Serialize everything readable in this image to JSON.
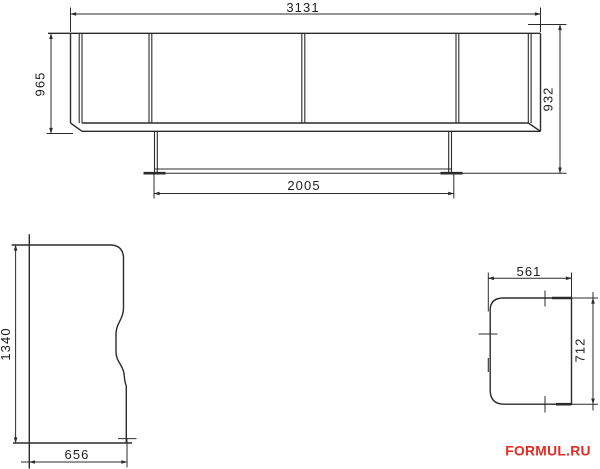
{
  "colors": {
    "background": "#ffffff",
    "line": "#2b2b2b",
    "dimension_text": "#1d1d1d",
    "watermark": "#e32b22"
  },
  "dimensions": {
    "front": {
      "overall_width": "3131",
      "left_height": "965",
      "right_height": "932",
      "base_width": "2005"
    },
    "side": {
      "height": "1340",
      "depth": "656"
    },
    "seat": {
      "width": "561",
      "depth": "712"
    }
  },
  "watermark": {
    "text": "FORMUL.RU"
  }
}
